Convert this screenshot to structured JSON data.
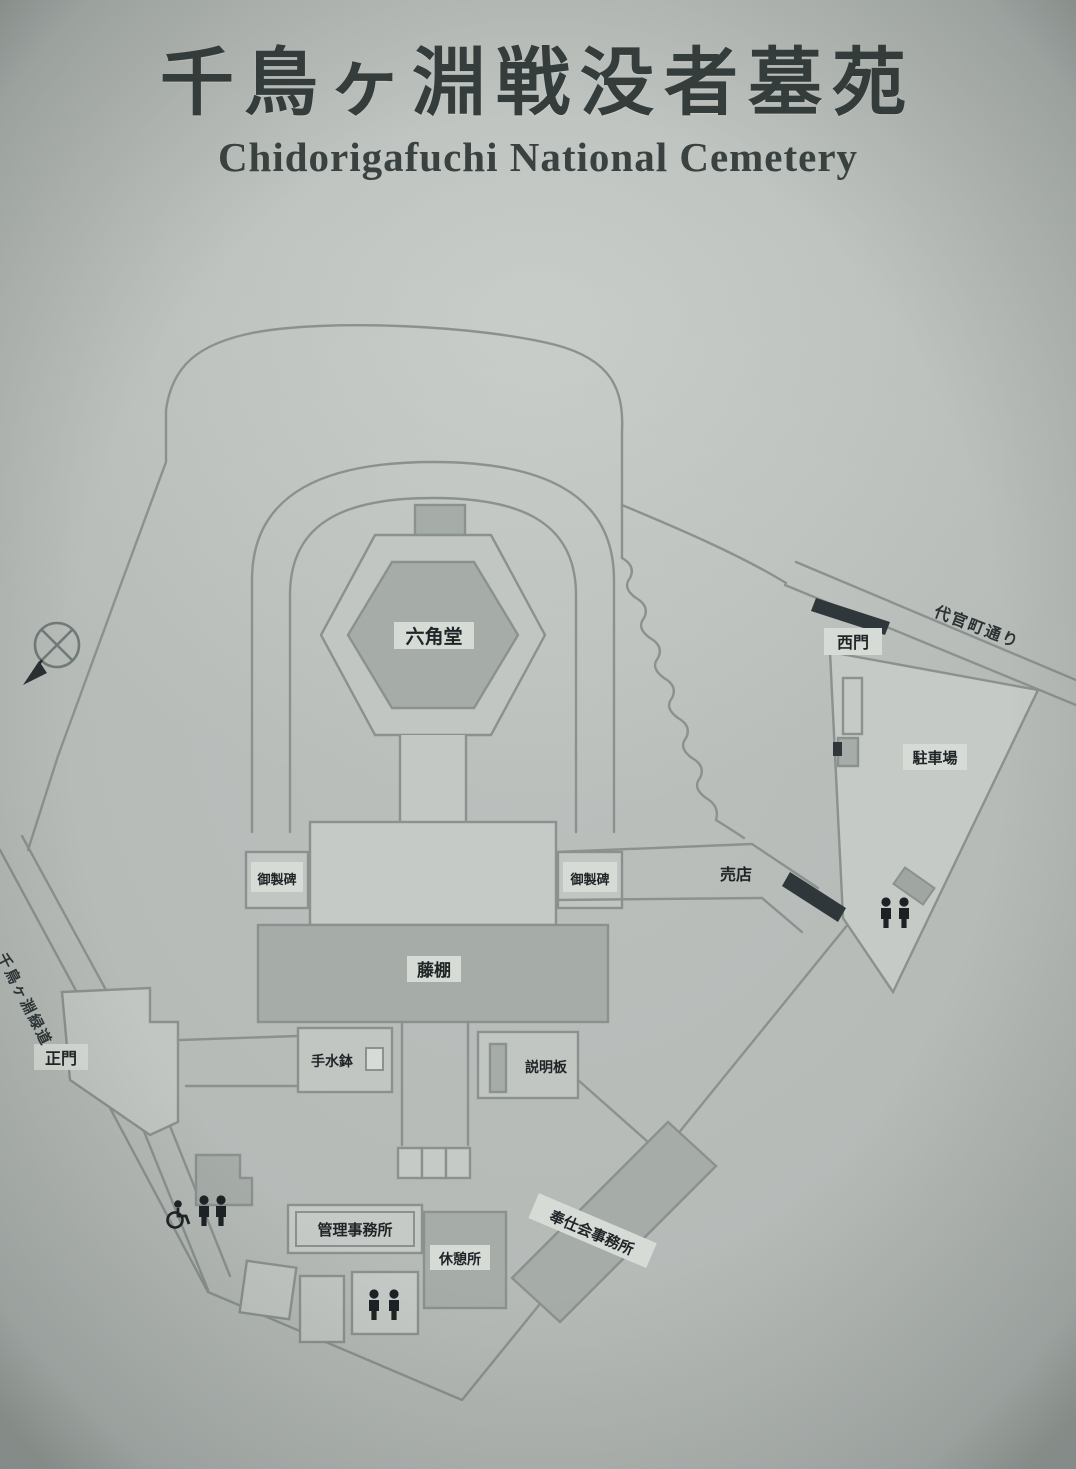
{
  "sign": {
    "title_ja": "千鳥ヶ淵戦没者墓苑",
    "title_en": "Chidorigafuchi National Cemetery"
  },
  "map": {
    "labels": {
      "hexagon_hall": "六角堂",
      "monument_left": "御製碑",
      "monument_right": "御製碑",
      "trellis": "藤棚",
      "water_basin": "手水鉢",
      "info_board": "説明板",
      "shop": "売店",
      "admin_office": "管理事務所",
      "rest_house": "休憩所",
      "service_office": "奉仕会事務所",
      "main_gate": "正門",
      "west_gate": "西門",
      "parking": "駐車場",
      "road_northeast": "代官町通り",
      "road_west": "千鳥ヶ淵緑道"
    },
    "icons": {
      "compass": "compass-rose",
      "wheelchair": "accessible-toilet",
      "restroom": "toilets"
    },
    "colors": {
      "panel": "#b7bbb8",
      "structure_fill": "#a6ada9",
      "open_area_fill": "#c6cac6",
      "line": "#8a918f",
      "ink": "#1f2527"
    }
  }
}
